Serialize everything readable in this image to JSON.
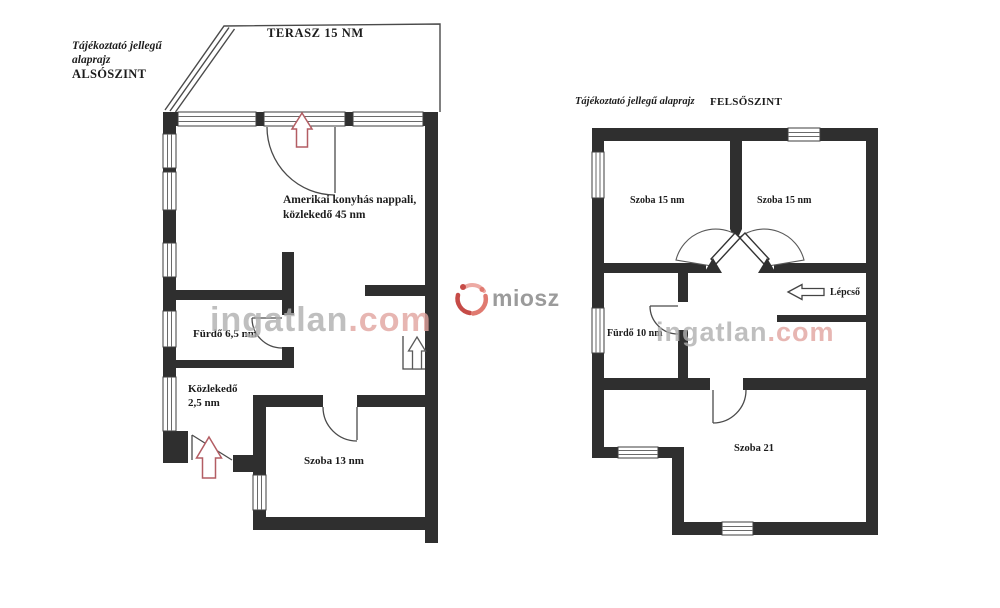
{
  "colors": {
    "wall": "#2f2f2f",
    "thin_line": "#4a4a4a",
    "entry_arrow_red": "#b35d63",
    "watermark_gray": "#b0b0b0",
    "watermark_red": "#e2a49f",
    "logo_red": "#c64b47",
    "logo_coral": "#e07a70",
    "logo_text_gray": "#9b9b9b"
  },
  "lower_plan": {
    "title_line1": "Tájékoztató jellegű",
    "title_line2": "alaprajz",
    "title_line3": "ALSÓSZINT",
    "terrace": "TERASZ 15 NM",
    "living_room_line1": "Amerikai konyhás nappali,",
    "living_room_line2": "közlekedő  45 nm",
    "bathroom": "Fürdő 6,5 nm",
    "hallway_line1": "Közlekedő",
    "hallway_line2": "2,5 nm",
    "room": "Szoba  13 nm"
  },
  "upper_plan": {
    "title": "Tájékoztató jellegű alaprajz",
    "level": "FELSŐSZINT",
    "room_left": "Szoba  15 nm",
    "room_right": "Szoba  15 nm",
    "stairs": "Lépcső",
    "bathroom": "Fürdő  10 nm",
    "room_big": "Szoba  21"
  },
  "watermark": {
    "brand_gray": "ingatlan",
    "brand_red": ".com",
    "logo": "miosz"
  }
}
